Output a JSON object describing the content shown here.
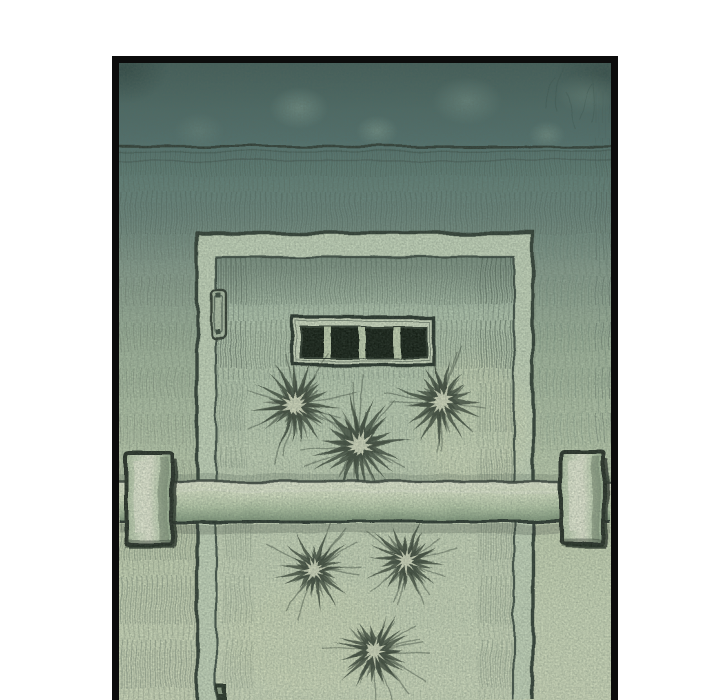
{
  "scene": {
    "type": "webtoon-comic-panel",
    "description": "Hand-drawn teal-green panel of a heavy metal door with a small barred slot window, a locking crossbar resting on two wall brackets, a side hinge, and dark frost-like starburst blast marks scattered on the door"
  },
  "palette": {
    "page_background": "#ffffff",
    "panel_border": "#0c0c0c",
    "wall_dark": "#4a6965",
    "wall_light": "#d6e0c2",
    "frame_face": "#ccdcc2",
    "door_surface": "#c8d8bd",
    "ink": "#2d3a31",
    "window_ring": "#d6e2c8",
    "window_dark": "#11150e",
    "window_bar": "#c8d6b6",
    "bar_highlight": "#eef2dc",
    "bar_shadow": "#7e9478",
    "burst_ink": "#313c30",
    "burst_center": "#e6eccf"
  },
  "artwork": {
    "window": {
      "panes": 4,
      "bars": 3
    },
    "starbursts": [
      {
        "cx": 295,
        "cy": 405,
        "r": 48,
        "seed": 11,
        "layer": "upper"
      },
      {
        "cx": 358,
        "cy": 444,
        "r": 53,
        "seed": 23,
        "layer": "upper"
      },
      {
        "cx": 441,
        "cy": 401,
        "r": 46,
        "seed": 37,
        "layer": "upper"
      },
      {
        "cx": 314,
        "cy": 570,
        "r": 41,
        "seed": 51,
        "layer": "lower"
      },
      {
        "cx": 406,
        "cy": 561,
        "r": 43,
        "seed": 67,
        "layer": "lower"
      },
      {
        "cx": 374,
        "cy": 651,
        "r": 46,
        "seed": 83,
        "layer": "lower"
      }
    ]
  }
}
